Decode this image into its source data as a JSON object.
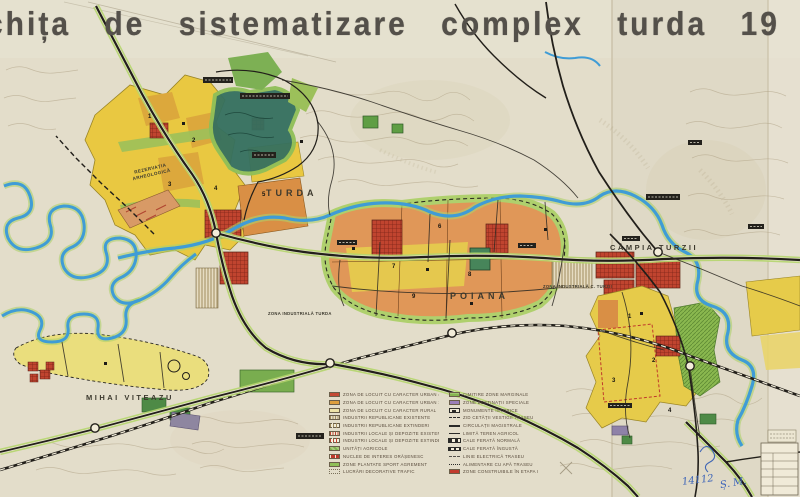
{
  "title": "chița de sistematizare complex turda 19",
  "map": {
    "labels": {
      "turda": "TURDA",
      "poiana": "POIANA",
      "campia_turzii": "CÂMPIA TURZII",
      "mihai_viteazu": "MIHAI VITEAZU",
      "rezervatia": "REZERVAȚIA ARHEOLOGICĂ",
      "zona_ind_turda": "ZONA INDUSTRIALĂ TURDA",
      "zona_ind_cturzii": "ZONA INDUSTRIALĂ C. TURZII"
    },
    "numbers": [
      "1",
      "2",
      "3",
      "4",
      "5",
      "6",
      "7",
      "8",
      "9",
      "1",
      "2",
      "3",
      "4"
    ]
  },
  "legend": {
    "left": [
      {
        "label": "ZONA DE LOCUIT CU CARACTER URBAN 4-5 NIV"
      },
      {
        "label": "ZONA DE LOCUIT CU CARACTER URBAN 1-2 NIV"
      },
      {
        "label": "ZONA DE LOCUIT CU CARACTER RURAL"
      },
      {
        "label": "INDUSTRII REPUBLICANE EXISTENTE"
      },
      {
        "label": "INDUSTRII REPUBLICANE EXTINDERI"
      },
      {
        "label": "INDUSTRII LOCALE ȘI DEPOZITE EXISTENTE"
      },
      {
        "label": "INDUSTRII LOCALE ȘI DEPOZITE EXTINDERI"
      },
      {
        "label": "UNITĂȚI AGRICOLE"
      },
      {
        "label": "NUCLEE DE INTERES ORĂȘENESC"
      },
      {
        "label": "ZONE PLANTATE SPORT AGREMENT"
      },
      {
        "label": "LUCRĂRI DECORATIVE TRAFIC"
      }
    ],
    "right": [
      {
        "label": "CIMITIRE ZONE MARGINALE"
      },
      {
        "label": "ZONE DESTINAȚII SPECIALE"
      },
      {
        "label": "MONUMENTE ISTORICE"
      },
      {
        "label": "ZID CETĂȚII VESTIGII TRASEU"
      },
      {
        "label": "CIRCULAȚII MAGISTRALE"
      },
      {
        "label": "LIMITĂ TEREN AGRICOL"
      },
      {
        "label": "CALE FERATĂ NORMALĂ"
      },
      {
        "label": "CALE FERATĂ ÎNGUSTĂ"
      },
      {
        "label": "LINIE ELECTRICĂ TRASEU"
      },
      {
        "label": "ALIMENTARE CU APĂ TRASEU"
      },
      {
        "label": "ZONE CONSTRUIBILE ÎN ETAPA I"
      }
    ]
  },
  "annotations": {
    "inventory_number": "14112",
    "inscription": "Ș. M."
  },
  "palette": {
    "paper": "#e3ddca",
    "residential_high": "#c44a35",
    "residential_low": "#de9f3e",
    "rural": "#eee3a8",
    "industry": "#a08c5d",
    "agriculture": "#7fae4e",
    "parks": "#8fbf58",
    "special": "#9b7fb8",
    "water": "#3f9cd6",
    "greenbelt": "#aed06b",
    "road": "#221f1a"
  }
}
